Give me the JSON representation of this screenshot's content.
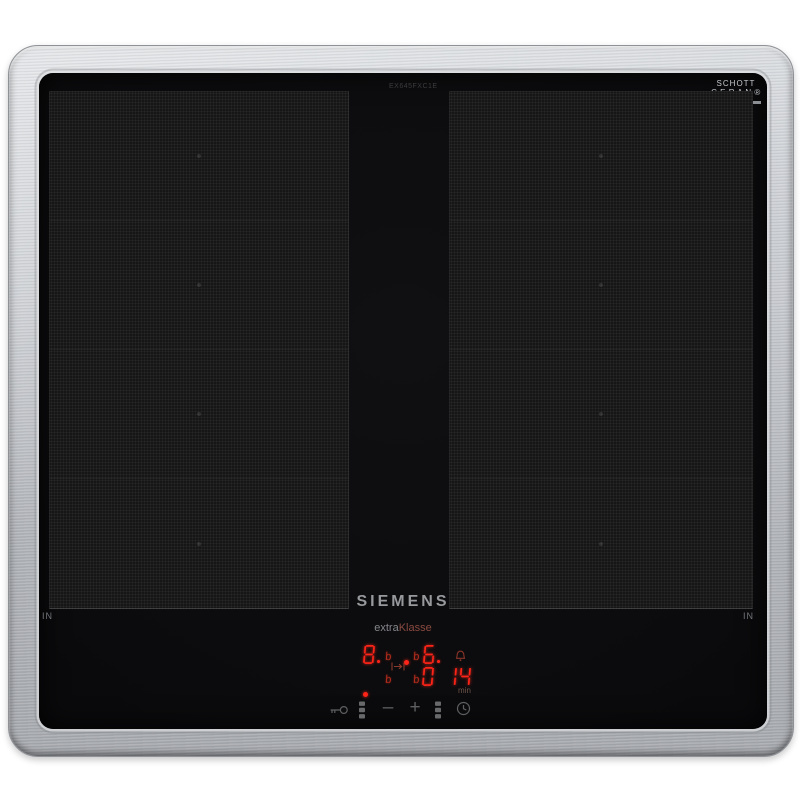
{
  "branding": {
    "logo": "SIEMENS",
    "series_normal": "extra",
    "series_accent": "Klasse",
    "model_code": "EX645FXC1E"
  },
  "glass_label": {
    "line1": "SCHOTT",
    "line2": "C E R A N ®"
  },
  "markers": {
    "in_left": "IN",
    "in_right": "IN"
  },
  "display": {
    "power_left": "8.",
    "power_right": "6.",
    "boost_top_left": "b",
    "boost_top_right": "b",
    "boost_bottom_left": "b",
    "boost_bottom_right": "b",
    "timer_hour": "0",
    "timer_minutes": "14",
    "min_label": "min"
  },
  "controls": {
    "minus_label": "–",
    "plus_label": "+"
  },
  "icons": {
    "alarm": "bell-icon",
    "bridge": "bridge-arrow-icon",
    "lock": "key-icon",
    "zone_select_left": "slider-dots-icon",
    "zone_select_right": "slider-dots-icon",
    "timer": "clock-icon"
  },
  "colors": {
    "led_red": "#ff2418",
    "led_dim": "#b02c1e",
    "steel": "#b9bcc1",
    "glass": "#0c0c0e",
    "series_accent": "#8a4a40"
  }
}
